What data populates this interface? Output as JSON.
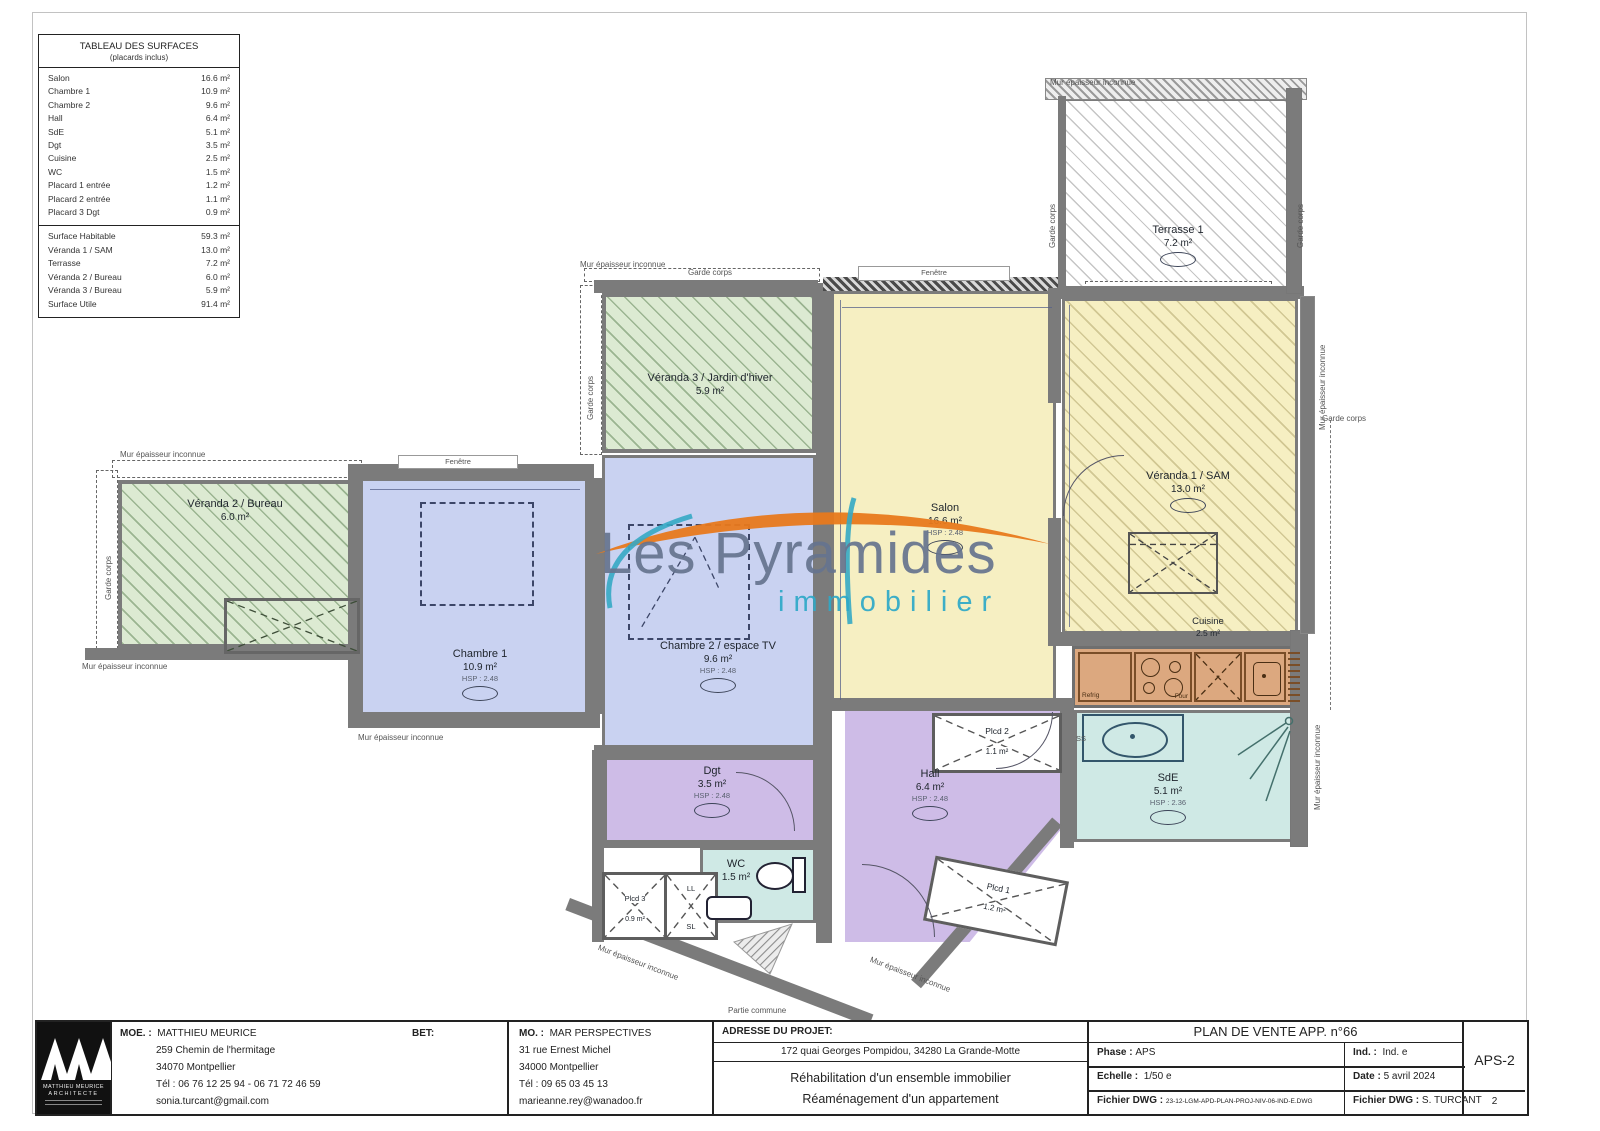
{
  "colors": {
    "wall": "#7b7b7b",
    "room_green": "#dcead2",
    "room_blue": "#c9d2f1",
    "room_yellow": "#f6efc2",
    "room_purple": "#cebce7",
    "room_teal": "#cfe9e5",
    "room_tan": "#dca87f",
    "watermark_orange": "#e8791c",
    "watermark_teal": "#2ea9c8",
    "watermark_gray": "#66748f"
  },
  "surface_table": {
    "title": "TABLEAU DES SURFACES",
    "subtitle": "(placards inclus)",
    "rows": [
      {
        "label": "Salon",
        "value": "16.6 m²"
      },
      {
        "label": "Chambre 1",
        "value": "10.9 m²"
      },
      {
        "label": "Chambre 2",
        "value": "9.6 m²"
      },
      {
        "label": "Hall",
        "value": "6.4 m²"
      },
      {
        "label": "SdE",
        "value": "5.1 m²"
      },
      {
        "label": "Dgt",
        "value": "3.5 m²"
      },
      {
        "label": "Cuisine",
        "value": "2.5 m²"
      },
      {
        "label": "WC",
        "value": "1.5 m²"
      },
      {
        "label": "Placard 1 entrée",
        "value": "1.2 m²"
      },
      {
        "label": "Placard 2 entrée",
        "value": "1.1 m²"
      },
      {
        "label": "Placard 3 Dgt",
        "value": "0.9 m²"
      }
    ],
    "summary": [
      {
        "label": "Surface Habitable",
        "value": "59.3 m²"
      },
      {
        "label": "Véranda 1 / SAM",
        "value": "13.0 m²"
      },
      {
        "label": "Terrasse",
        "value": "7.2 m²"
      },
      {
        "label": "Véranda 2 / Bureau",
        "value": "6.0 m²"
      },
      {
        "label": "Véranda 3 / Bureau",
        "value": "5.9 m²"
      },
      {
        "label": "Surface Utile",
        "value": "91.4 m²"
      }
    ]
  },
  "watermark": {
    "brand": "Les Pyramides",
    "tagline": "immobilier"
  },
  "rooms": {
    "veranda2": {
      "name": "Véranda 2 / Bureau",
      "area": "6.0 m²"
    },
    "veranda3": {
      "name": "Véranda 3 / Jardin d'hiver",
      "area": "5.9 m²"
    },
    "terrasse": {
      "name": "Terrasse 1",
      "area": "7.2 m²"
    },
    "salon": {
      "name": "Salon",
      "area": "16.6 m²",
      "hsp": "HSP : 2.48"
    },
    "veranda1": {
      "name": "Véranda 1 / SAM",
      "area": "13.0 m²"
    },
    "chambre1": {
      "name": "Chambre 1",
      "area": "10.9 m²",
      "hsp": "HSP : 2.48"
    },
    "chambre2": {
      "name": "Chambre 2 / espace TV",
      "area": "9.6 m²",
      "hsp": "HSP : 2.48"
    },
    "cuisine": {
      "name": "Cuisine",
      "area": "2.5 m²"
    },
    "sde": {
      "name": "SdE",
      "area": "5.1 m²",
      "hsp": "HSP : 2.36"
    },
    "hall": {
      "name": "Hall",
      "area": "6.4 m²",
      "hsp": "HSP : 2.48"
    },
    "dgt": {
      "name": "Dgt",
      "area": "3.5 m²",
      "hsp": "HSP : 2.48"
    },
    "wc": {
      "name": "WC",
      "area": "1.5 m²"
    },
    "plcd1": {
      "name": "Plcd 1",
      "area": "1.2 m²"
    },
    "plcd2": {
      "name": "Plcd 2",
      "area": "1.1 m²"
    },
    "plcd3": {
      "name": "Plcd 3",
      "area": "0.9 m²"
    }
  },
  "annotations": {
    "mur": "Mur épaisseur inconnue",
    "garde_corps": "Garde corps",
    "fenetre": "Fenêtre",
    "partie_commune": "Partie commune",
    "refrig": "Refrig",
    "four": "Four",
    "ll": "LL",
    "sl": "SL",
    "ss": "SS"
  },
  "title_block": {
    "moe_label": "MOE. :",
    "moe_name": "MATTHIEU MEURICE",
    "bet_label": "BET:",
    "moe_address1": "259 Chemin de l'hermitage",
    "moe_address2": "34070 Montpellier",
    "moe_tel": "Tél : 06 76 12 25 94 - 06 71 72 46 59",
    "moe_email": "sonia.turcant@gmail.com",
    "mo_label": "MO. :",
    "mo_name": "MAR PERSPECTIVES",
    "mo_address1": "31 rue Ernest Michel",
    "mo_address2": "34000 Montpellier",
    "mo_tel": "Tél : 09 65 03 45 13",
    "mo_email": "marieanne.rey@wanadoo.fr",
    "adresse_label": "ADRESSE DU PROJET:",
    "adresse": "172 quai Georges Pompidou, 34280 La Grande-Motte",
    "project_line1": "Réhabilitation d'un ensemble immobilier",
    "project_line2": "Réaménagement d'un appartement",
    "plan_title": "PLAN DE VENTE APP. n°66",
    "phase_label": "Phase :",
    "phase": "APS",
    "echelle_label": "Echelle :",
    "echelle": "1/50 e",
    "fichier_label": "Fichier DWG :",
    "fichier": "23-12-LGM-APD-PLAN-PROJ-NIV-06-IND-E.DWG",
    "ind_label": "Ind. :",
    "ind": "Ind. e",
    "date_label": "Date :",
    "date": "5 avril 2024",
    "fichier2_label": "Fichier DWG :",
    "fichier2": "S. TURCANT",
    "doc_code": "APS-2",
    "page": "2",
    "logo_line1": "MATTHIEU MEURICE",
    "logo_line2": "ARCHITECTE"
  }
}
